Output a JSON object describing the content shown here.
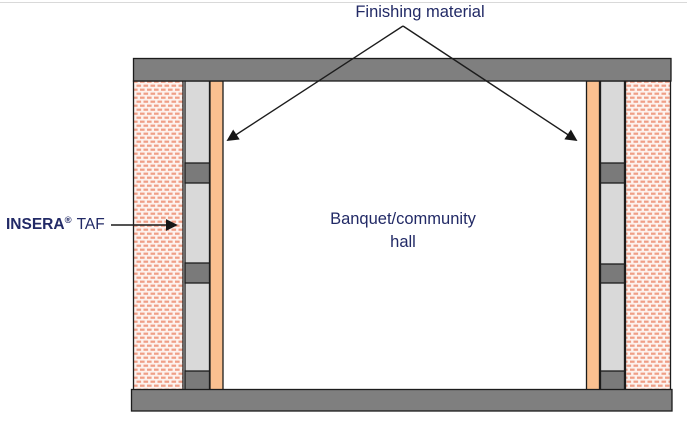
{
  "labels": {
    "finishing_material": "Finishing material",
    "insera_brand": "INSERA",
    "insera_reg": "®",
    "insera_suffix": "TAF",
    "hall_line1": "Banquet/community",
    "hall_line2": "hall"
  },
  "colors": {
    "slab_gray": "#7f7f7f",
    "block_gray": "#7a7a7a",
    "stud_light_gray": "#d9d9d9",
    "finish_orange": "#fac090",
    "brick_bg": "#fdf2ee",
    "brick_dash": "#ef9e86",
    "outline_black": "#1c1c1c",
    "navy_text": "#222a66",
    "divider_gray": "#d9d9d9"
  }
}
